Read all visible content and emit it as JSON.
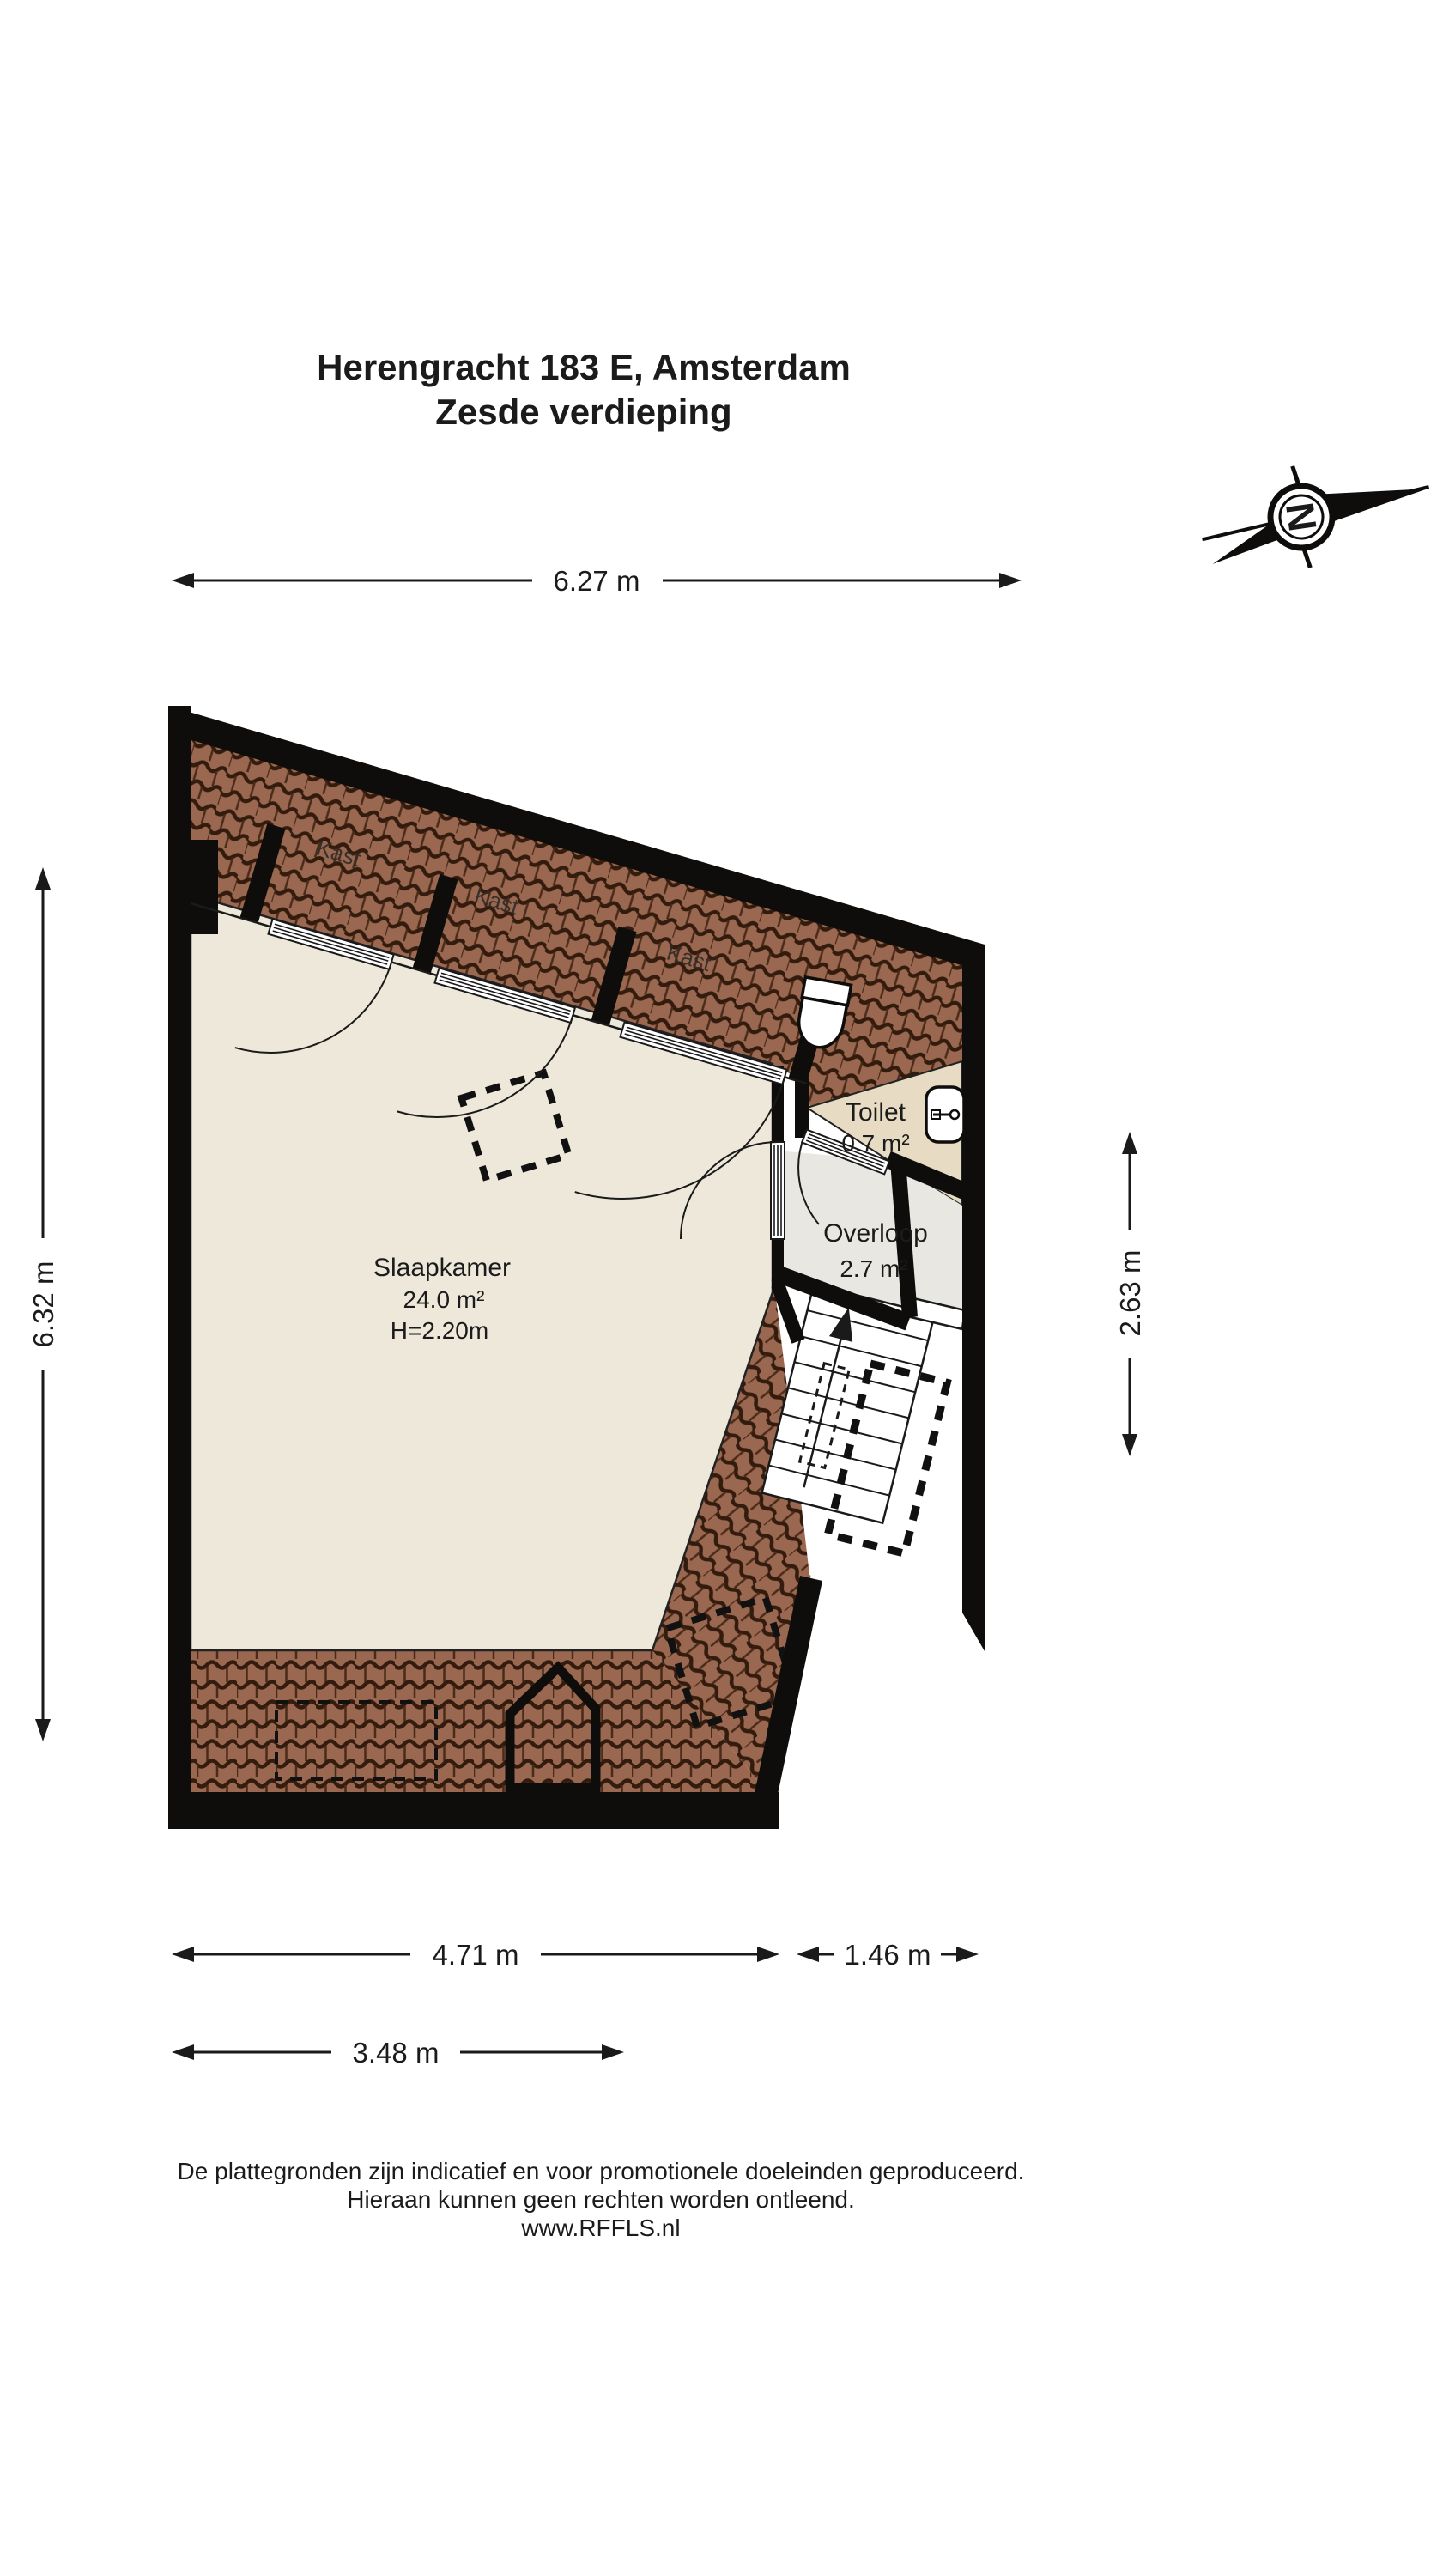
{
  "title": {
    "line1": "Herengracht 183 E, Amsterdam",
    "line2": "Zesde verdieping"
  },
  "compass": {
    "north_label": "N"
  },
  "floorplan": {
    "rooms": {
      "slaapkamer": {
        "name": "Slaapkamer",
        "area": "24.0 m²",
        "ceiling_height": "H=2.20m"
      },
      "toilet": {
        "name": "Toilet",
        "area": "0.7 m²"
      },
      "overloop": {
        "name": "Overloop",
        "area": "2.7 m²"
      },
      "kast_labels": [
        "Kast",
        "Kast",
        "Kast"
      ]
    },
    "dimensions": {
      "top": "6.27 m",
      "left": "6.32 m",
      "right": "2.63 m",
      "bottom_left": "4.71 m",
      "bottom_right": "1.46 m",
      "bottom_lower": "3.48 m"
    }
  },
  "footer": {
    "line1": "De plattegronden zijn indicatief en voor promotionele doeleinden geproduceerd.",
    "line2": "Hieraan kunnen geen rechten worden ontleend.",
    "line3": "www.RFFLS.nl"
  },
  "colors": {
    "wall": "#0e0d0b",
    "roof_tile": "#9a6850",
    "roof_tile_line": "#331c0e",
    "bedroom_floor": "#ede8da",
    "toilet_floor": "#e7dcc3",
    "overloop_floor": "#e9e7e1"
  }
}
